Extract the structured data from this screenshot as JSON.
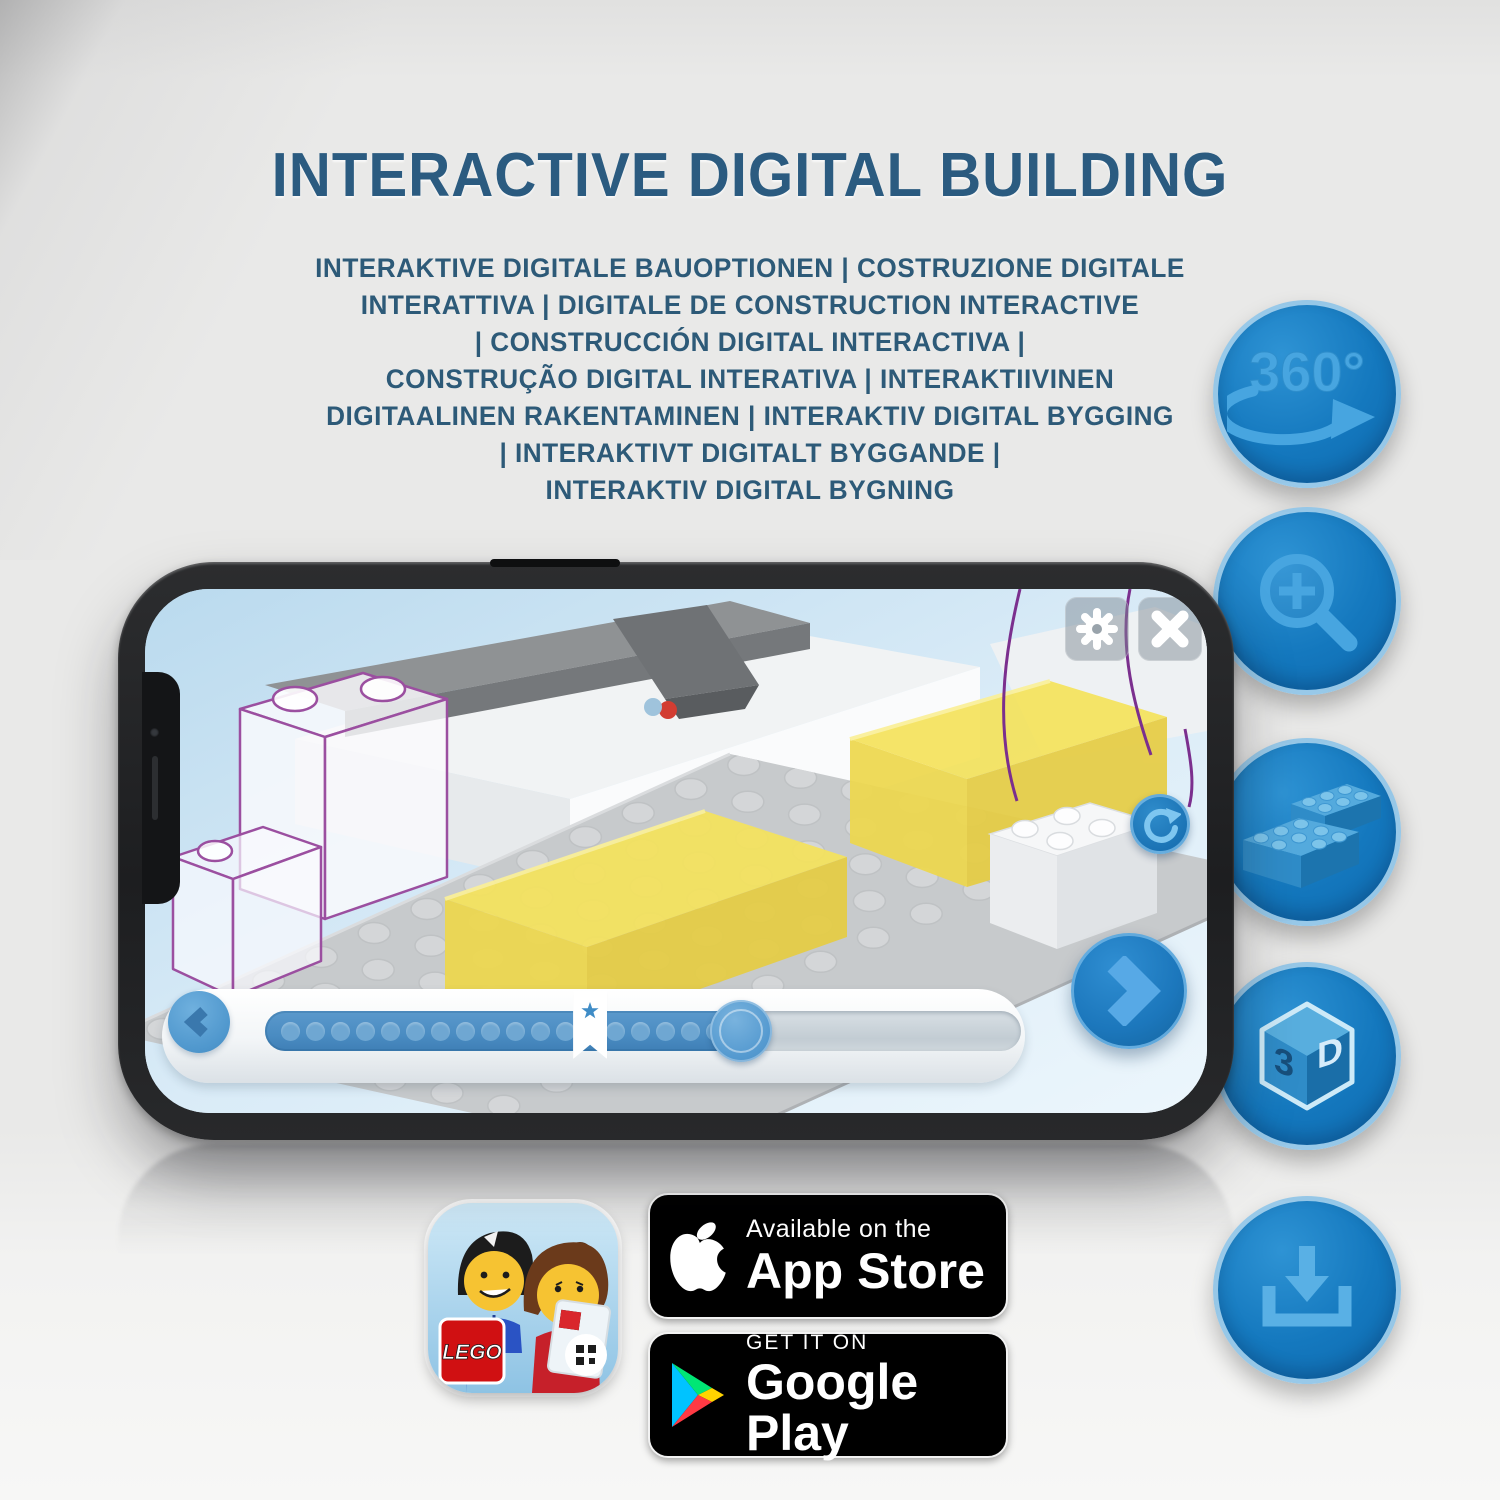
{
  "title": {
    "text": "INTERACTIVE DIGITAL BUILDING"
  },
  "subtitle": {
    "lines": [
      "INTERAKTIVE DIGITALE BAUOPTIONEN | COSTRUZIONE DIGITALE",
      "INTERATTIVA | DIGITALE DE CONSTRUCTION INTERACTIVE",
      "| CONSTRUCCIÓN DIGITAL INTERACTIVA |",
      "CONSTRUÇÃO DIGITAL INTERATIVA | INTERAKTIIVINEN",
      "DIGITAALINEN RAKENTAMINEN | INTERAKTIV DIGITAL BYGGING",
      "| INTERAKTIVT DIGITALT BYGGANDE |",
      "INTERAKTIV DIGITAL BYGNING"
    ]
  },
  "features": {
    "rotate360": {
      "label": "360°"
    },
    "cube3d": {
      "left_face": "3",
      "right_face": "D"
    }
  },
  "phone": {
    "slider": {
      "dot_count": 18,
      "star_pct": 43,
      "handle_pct": 63
    }
  },
  "store": {
    "app_icon": {
      "logo_text": "LEGO"
    },
    "apple": {
      "line1": "Available on the",
      "line2": "App Store"
    },
    "google": {
      "line1": "GET IT ON",
      "line2": "Google Play"
    }
  },
  "colors": {
    "title_blue": "#2b5b80",
    "badge_blue": "#1478be",
    "icon_blue": "#47a5e0",
    "screen_sky": "#cfe4f3",
    "brick_yellow": "#f2df52",
    "ghost_outline_purple": "#9b4fa0"
  }
}
